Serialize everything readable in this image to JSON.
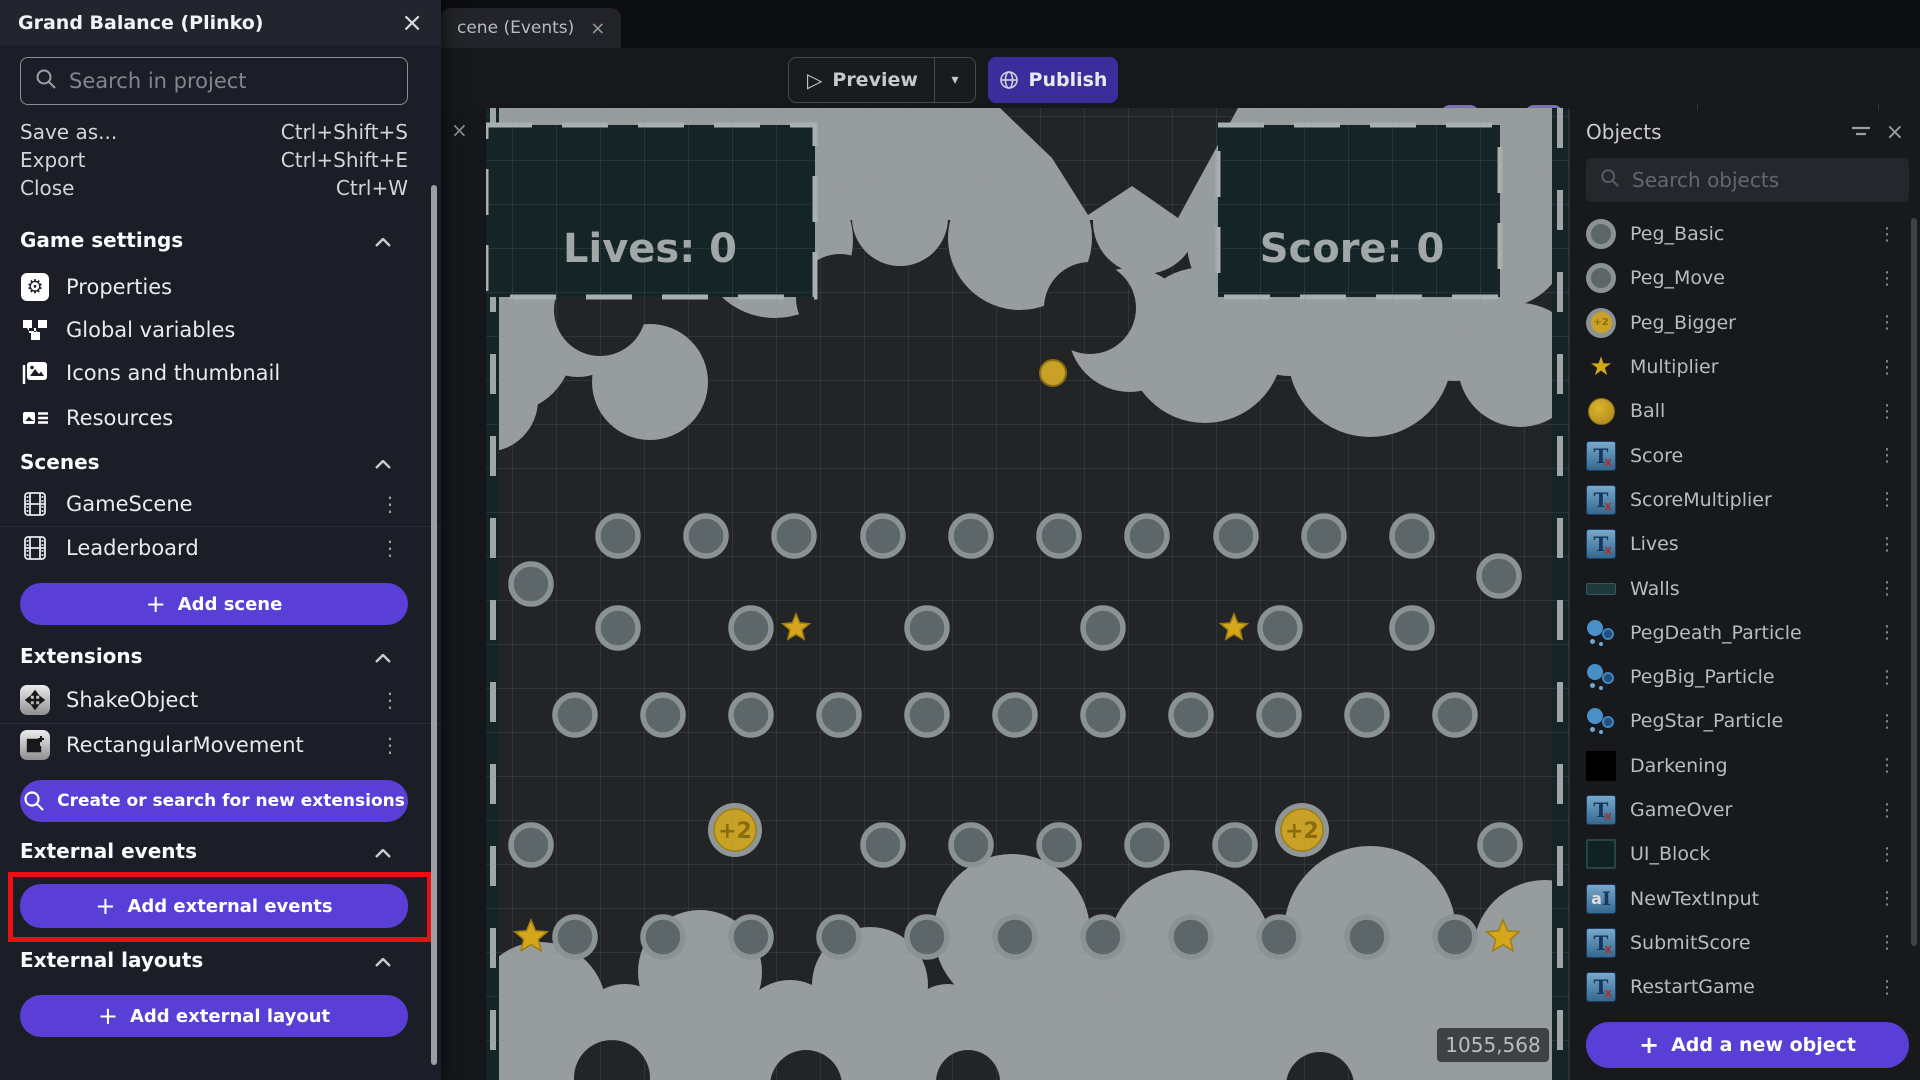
{
  "colors": {
    "accent_purple": "#5a3fd6",
    "publish_purple": "#3b2d9b",
    "highlight_red": "#e81010",
    "toolbar_active": "#7c71b5",
    "gold": "#c9a125",
    "cloud_gray": "#979c9d",
    "wall_teal": "#152527",
    "canvas_bg": "#222426"
  },
  "tab_bar": {
    "active_tab": {
      "label": "cene (Events)",
      "close_glyph": "×"
    }
  },
  "toolbar": {
    "preview_label": "Preview",
    "publish_label": "Publish"
  },
  "project_panel": {
    "title": "Grand Balance (Plinko)",
    "close_glyph": "×",
    "search_placeholder": "Search in project",
    "menu_items": [
      {
        "label": "Save as...",
        "shortcut": "Ctrl+Shift+S"
      },
      {
        "label": "Export",
        "shortcut": "Ctrl+Shift+E"
      },
      {
        "label": "Close",
        "shortcut": "Ctrl+W"
      }
    ],
    "sections": {
      "game_settings": {
        "title": "Game settings",
        "items": [
          {
            "label": "Properties"
          },
          {
            "label": "Global variables"
          },
          {
            "label": "Icons and thumbnail"
          },
          {
            "label": "Resources"
          }
        ]
      },
      "scenes": {
        "title": "Scenes",
        "items": [
          {
            "label": "GameScene"
          },
          {
            "label": "Leaderboard"
          }
        ],
        "button_label": "Add scene"
      },
      "extensions": {
        "title": "Extensions",
        "items": [
          {
            "label": "ShakeObject"
          },
          {
            "label": "RectangularMovement"
          }
        ],
        "button_label": "Create or search for new extensions"
      },
      "external_events": {
        "title": "External events",
        "button_label": "Add external events"
      },
      "external_layouts": {
        "title": "External layouts",
        "button_label": "Add external layout"
      }
    }
  },
  "objects_panel": {
    "title": "Objects",
    "search_placeholder": "Search objects",
    "add_button_label": "Add a new object",
    "objects": [
      {
        "name": "Peg_Basic",
        "icon": "peg-icon"
      },
      {
        "name": "Peg_Move",
        "icon": "peg-icon"
      },
      {
        "name": "Peg_Bigger",
        "icon": "coin-icon"
      },
      {
        "name": "Multiplier",
        "icon": "star-icon"
      },
      {
        "name": "Ball",
        "icon": "ball-icon"
      },
      {
        "name": "Score",
        "icon": "text-icon"
      },
      {
        "name": "ScoreMultiplier",
        "icon": "text-icon"
      },
      {
        "name": "Lives",
        "icon": "text-icon"
      },
      {
        "name": "Walls",
        "icon": "wall-icon"
      },
      {
        "name": "PegDeath_Particle",
        "icon": "particle-icon"
      },
      {
        "name": "PegBig_Particle",
        "icon": "particle-icon"
      },
      {
        "name": "PegStar_Particle",
        "icon": "particle-icon"
      },
      {
        "name": "Darkening",
        "icon": "black-icon"
      },
      {
        "name": "GameOver",
        "icon": "text-icon"
      },
      {
        "name": "UI_Block",
        "icon": "block-icon"
      },
      {
        "name": "NewTextInput",
        "icon": "input-icon"
      },
      {
        "name": "SubmitScore",
        "icon": "text-icon"
      },
      {
        "name": "RestartGame",
        "icon": "text-icon"
      }
    ]
  },
  "scene": {
    "hud": {
      "lives": "Lives: 0",
      "score": "Score: 0",
      "multiplier": "25%"
    },
    "cursor_coordinates": "1055,568",
    "pegs": {
      "radius": 20,
      "rows": [
        {
          "y": 536,
          "xs": [
            618,
            706,
            794,
            883,
            971,
            1059,
            1147,
            1236,
            1324,
            1412
          ]
        },
        {
          "y": 584,
          "xs": [
            531
          ]
        },
        {
          "y": 576,
          "xs": [
            1499
          ]
        },
        {
          "y": 628,
          "xs": [
            618,
            751,
            927,
            1103,
            1280,
            1412
          ]
        },
        {
          "y": 715,
          "xs": [
            575,
            663,
            751,
            839,
            927,
            1015,
            1103,
            1191,
            1279,
            1367,
            1455
          ]
        },
        {
          "y": 845,
          "xs": [
            531,
            883,
            971,
            1059,
            1147,
            1235,
            1500
          ]
        },
        {
          "y": 937,
          "xs": [
            575,
            663,
            751,
            839,
            927,
            1015,
            1103,
            1191,
            1279,
            1367,
            1455
          ]
        }
      ]
    },
    "stars": [
      {
        "x": 796,
        "y": 628,
        "r": 14
      },
      {
        "x": 1234,
        "y": 628,
        "r": 14
      },
      {
        "x": 531,
        "y": 937,
        "r": 17
      },
      {
        "x": 1503,
        "y": 937,
        "r": 17
      }
    ],
    "coins": [
      {
        "x": 735,
        "y": 830,
        "label": "+2"
      },
      {
        "x": 1302,
        "y": 830,
        "label": "+2"
      }
    ],
    "ball": {
      "x": 1053,
      "y": 373,
      "r": 13
    }
  }
}
